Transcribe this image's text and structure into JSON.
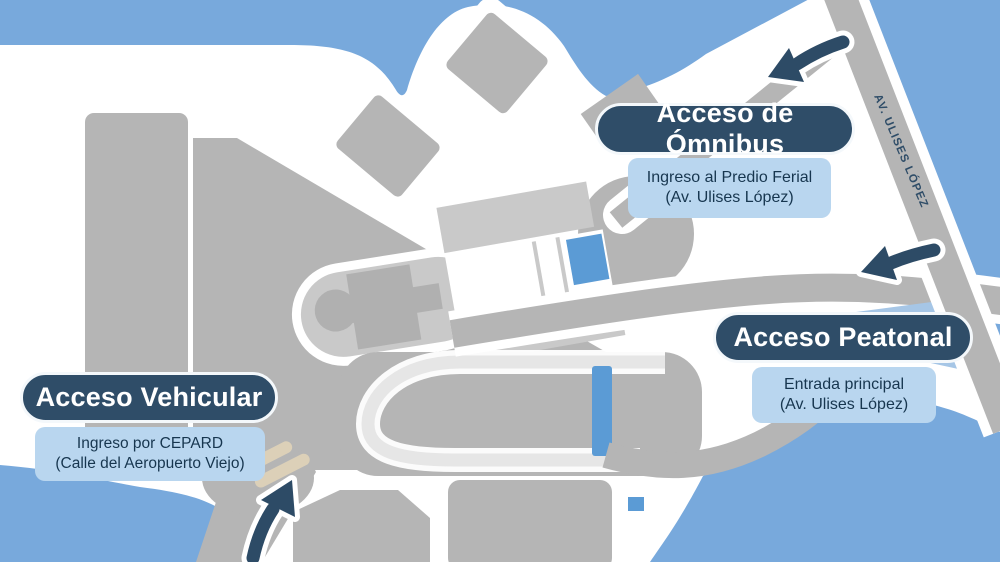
{
  "map": {
    "title_semantic": "Mapa de accesos al Predio Ferial",
    "road_label": "AV. ULISES LÓPEZ"
  },
  "callouts": {
    "omnibus": {
      "title": "Acceso de Ómnibus",
      "line1": "Ingreso al Predio Ferial",
      "line2": "(Av. Ulises López)"
    },
    "peatonal": {
      "title": "Acceso Peatonal",
      "line1": "Entrada principal",
      "line2": "(Av. Ulises López)"
    },
    "vehicular": {
      "title": "Acceso Vehicular",
      "line1": "Ingreso por CEPARD",
      "line2": "(Calle del Aeropuerto Viejo)"
    }
  },
  "icons": {
    "omnibus_arrow": "arrow-pointing-down-left-to-bus-entrance",
    "peatonal_arrow": "arrow-pointing-left-to-pedestrian-entrance",
    "vehicular_arrow": "arrow-pointing-up-right-to-vehicle-entrance"
  },
  "colors": {
    "background_water_blue": "#78a9dc",
    "land_white": "#ffffff",
    "block_gray": "#b5b5b5",
    "panel_light_gray": "#c9c9c9",
    "track_light_gray": "#e6e6e6",
    "accent_map_blue": "#5b9bd5",
    "navy_label": "#2f4d68",
    "info_box_blue": "#b9d6ef",
    "info_text_navy": "#17364f",
    "beige_entrance": "#dcd0b8"
  }
}
